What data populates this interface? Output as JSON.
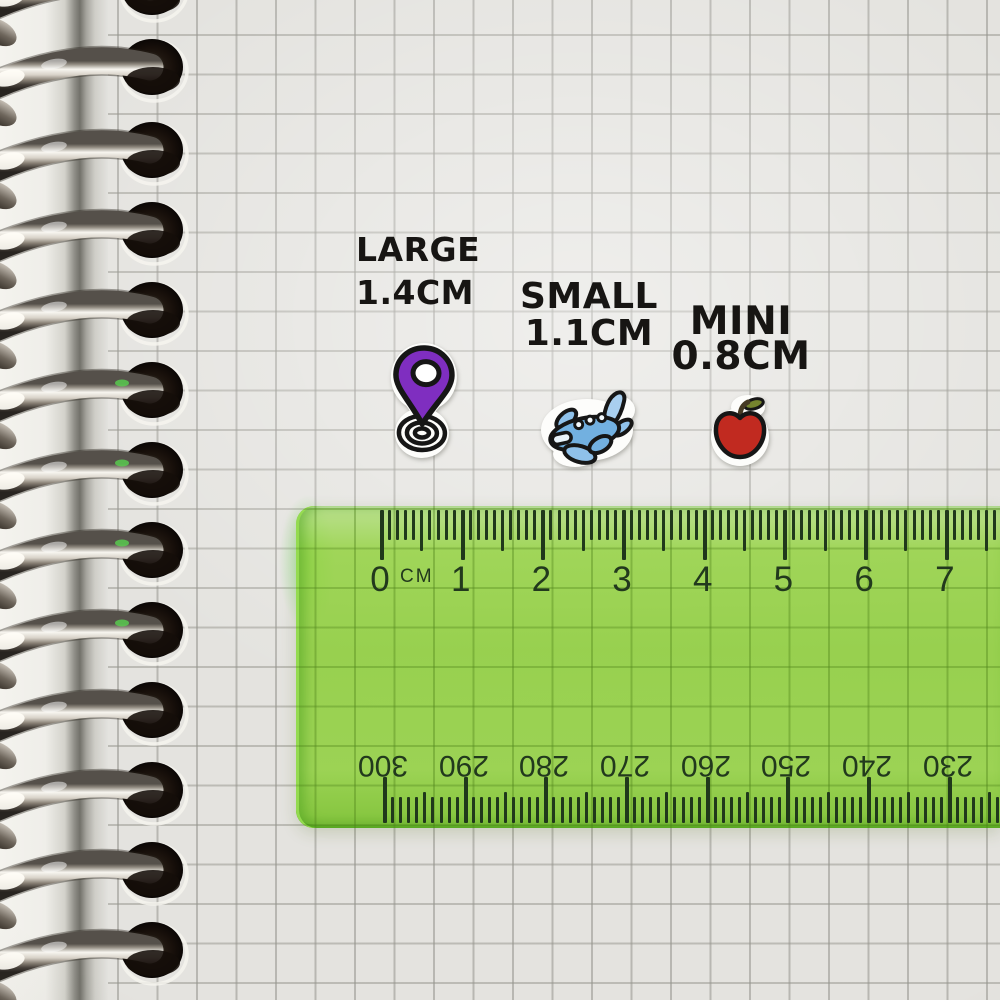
{
  "labels": {
    "large": {
      "name": "LARGE",
      "size": "1.4CM"
    },
    "small": {
      "name": "SMALL",
      "size": "1.1CM"
    },
    "mini": {
      "name": "MINI",
      "size": "0.8CM"
    }
  },
  "stickers": {
    "large": {
      "icon": "location-pin-sticker",
      "pin_color": "#7f2ec0"
    },
    "small": {
      "icon": "airplane-sticker",
      "body_color": "#72b0e0",
      "wing_color": "#a9cfef"
    },
    "mini": {
      "icon": "apple-sticker",
      "apple_color": "#c12a20",
      "leaf_color": "#75842e"
    }
  },
  "ruler": {
    "unit_label": "CM",
    "top_scale": [
      "0",
      "1",
      "2",
      "3",
      "4",
      "5",
      "6",
      "7"
    ],
    "bottom_scale": [
      "300",
      "290",
      "280",
      "270",
      "260",
      "250",
      "240",
      "230"
    ],
    "plastic_color": "#8cc63e",
    "tick_color": "#20381b"
  },
  "notebook": {
    "paper_color": "#e4e3df",
    "grid_line_color": "#c6c6c0",
    "binding": "silver-spiral-rings"
  }
}
